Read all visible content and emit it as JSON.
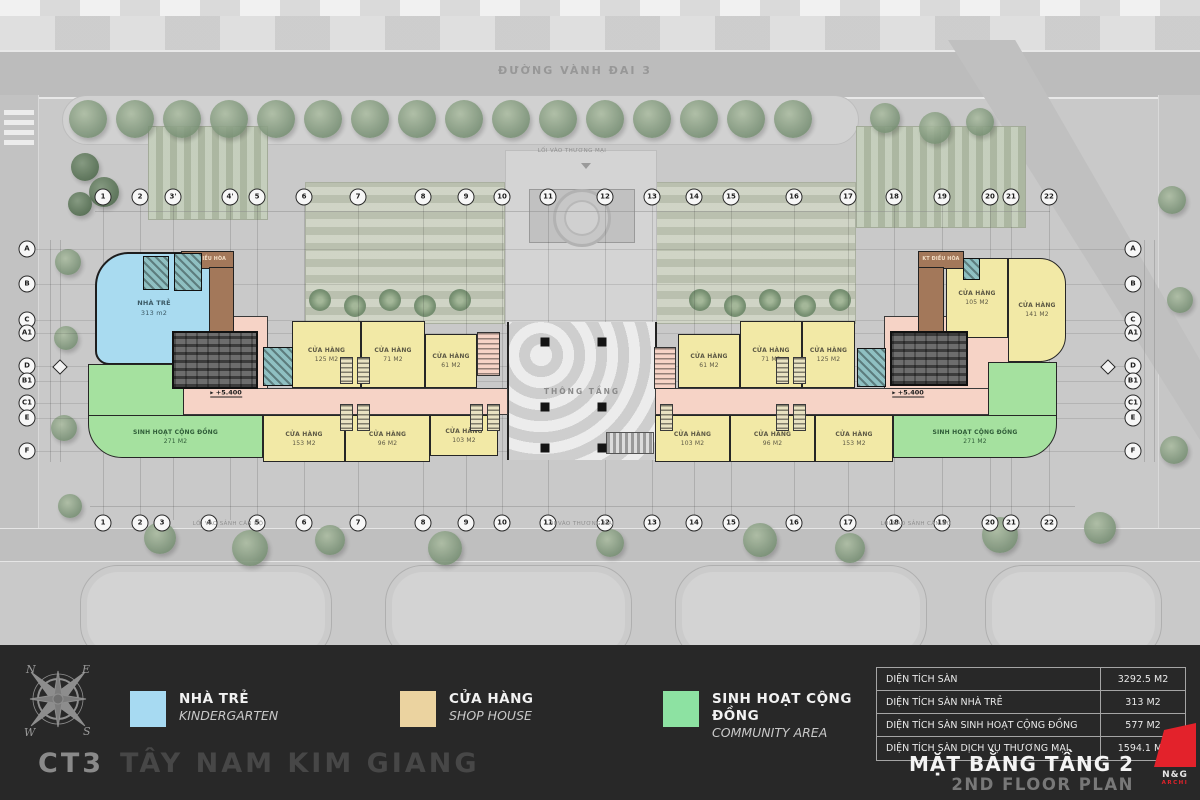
{
  "site": {
    "road_label": "ĐƯỜNG VÀNH ĐAI 3",
    "entrances": [
      {
        "label": "LỐI VÀO THƯƠNG MẠI",
        "x": 572,
        "y": 151,
        "arrow_y": 166,
        "arrow_x": 586
      },
      {
        "label": "LỐI VÀO SẢNH CĂN HỘ",
        "x": 228,
        "y": 524
      },
      {
        "label": "LỐI VÀO THƯƠNG MẠI",
        "x": 580,
        "y": 524
      },
      {
        "label": "LỐI VÀO SẢNH CĂN HỘ",
        "x": 916,
        "y": 524
      }
    ]
  },
  "plan": {
    "void_label": "THÔNG TẦNG",
    "level_label": "+5.400",
    "level_markers": [
      {
        "x": 226,
        "y": 393
      },
      {
        "x": 908,
        "y": 393
      }
    ],
    "grid_top": [
      {
        "label": "1",
        "x": 103
      },
      {
        "label": "2",
        "x": 140
      },
      {
        "label": "3'",
        "x": 173
      },
      {
        "label": "4'",
        "x": 230
      },
      {
        "label": "5",
        "x": 257
      },
      {
        "label": "6",
        "x": 304
      },
      {
        "label": "7",
        "x": 358
      },
      {
        "label": "8",
        "x": 423
      },
      {
        "label": "9",
        "x": 466
      },
      {
        "label": "10",
        "x": 502
      },
      {
        "label": "11",
        "x": 548
      },
      {
        "label": "12",
        "x": 605
      },
      {
        "label": "13",
        "x": 652
      },
      {
        "label": "14",
        "x": 694
      },
      {
        "label": "15",
        "x": 731
      },
      {
        "label": "16",
        "x": 794
      },
      {
        "label": "17",
        "x": 848
      },
      {
        "label": "18",
        "x": 894
      },
      {
        "label": "19",
        "x": 942
      },
      {
        "label": "20",
        "x": 990
      },
      {
        "label": "21",
        "x": 1011
      },
      {
        "label": "22",
        "x": 1049
      }
    ],
    "grid_bottom": [
      {
        "label": "1",
        "x": 103
      },
      {
        "label": "2",
        "x": 140
      },
      {
        "label": "3",
        "x": 162
      },
      {
        "label": "4",
        "x": 209
      },
      {
        "label": "5",
        "x": 257
      },
      {
        "label": "6",
        "x": 304
      },
      {
        "label": "7",
        "x": 358
      },
      {
        "label": "8",
        "x": 423
      },
      {
        "label": "9",
        "x": 466
      },
      {
        "label": "10",
        "x": 502
      },
      {
        "label": "11",
        "x": 548
      },
      {
        "label": "12",
        "x": 605
      },
      {
        "label": "13",
        "x": 652
      },
      {
        "label": "14",
        "x": 694
      },
      {
        "label": "15",
        "x": 731
      },
      {
        "label": "16",
        "x": 794
      },
      {
        "label": "17",
        "x": 848
      },
      {
        "label": "18",
        "x": 894
      },
      {
        "label": "19",
        "x": 942
      },
      {
        "label": "20",
        "x": 990
      },
      {
        "label": "21",
        "x": 1011
      },
      {
        "label": "22",
        "x": 1049
      }
    ],
    "grid_left": [
      {
        "label": "A",
        "y": 249
      },
      {
        "label": "B",
        "y": 284
      },
      {
        "label": "C",
        "y": 320
      },
      {
        "label": "A1",
        "y": 333
      },
      {
        "label": "D",
        "y": 366
      },
      {
        "label": "B1",
        "y": 381
      },
      {
        "label": "C1",
        "y": 403
      },
      {
        "label": "E",
        "y": 418
      },
      {
        "label": "F",
        "y": 451
      }
    ],
    "grid_right": [
      {
        "label": "A",
        "y": 249
      },
      {
        "label": "B",
        "y": 284
      },
      {
        "label": "C",
        "y": 320
      },
      {
        "label": "A1",
        "y": 333
      },
      {
        "label": "D",
        "y": 366
      },
      {
        "label": "B1",
        "y": 381
      },
      {
        "label": "C1",
        "y": 403
      },
      {
        "label": "E",
        "y": 418
      },
      {
        "label": "F",
        "y": 451
      }
    ],
    "rooms": [
      {
        "t": "corridor",
        "x": 150,
        "y": 316,
        "w": 118,
        "h": 75
      },
      {
        "t": "corridor",
        "x": 150,
        "y": 388,
        "w": 358,
        "h": 27
      },
      {
        "t": "corridor",
        "x": 884,
        "y": 316,
        "w": 158,
        "h": 75
      },
      {
        "t": "corridor",
        "x": 655,
        "y": 388,
        "w": 387,
        "h": 27
      },
      {
        "t": "kindergarten",
        "x": 95,
        "y": 252,
        "w": 118,
        "h": 113,
        "r": "34px 0 0 14px",
        "n": "NHÀ TRẺ",
        "a": "313 m2"
      },
      {
        "t": "community",
        "x": 88,
        "y": 364,
        "w": 96,
        "h": 52
      },
      {
        "t": "community",
        "x": 88,
        "y": 415,
        "w": 175,
        "h": 43,
        "r": "0 0 0 34px",
        "n": "SINH HOẠT CỘNG ĐỒNG",
        "a": "271 M2"
      },
      {
        "t": "community",
        "x": 988,
        "y": 362,
        "w": 69,
        "h": 54
      },
      {
        "t": "community",
        "x": 893,
        "y": 415,
        "w": 164,
        "h": 43,
        "r": "0 0 34px 0",
        "n": "SINH HOẠT CỘNG ĐỒNG",
        "a": "271 M2"
      },
      {
        "t": "shop",
        "x": 292,
        "y": 321,
        "w": 69,
        "h": 67,
        "n": "CỬA HÀNG",
        "a": "125 M2"
      },
      {
        "t": "shop",
        "x": 361,
        "y": 321,
        "w": 64,
        "h": 67,
        "n": "CỬA HÀNG",
        "a": "71 M2"
      },
      {
        "t": "shop",
        "x": 425,
        "y": 334,
        "w": 52,
        "h": 54,
        "n": "CỬA HÀNG",
        "a": "61 M2"
      },
      {
        "t": "shop",
        "x": 263,
        "y": 415,
        "w": 82,
        "h": 47,
        "n": "CỬA HÀNG",
        "a": "153 M2"
      },
      {
        "t": "shop",
        "x": 345,
        "y": 415,
        "w": 85,
        "h": 47,
        "n": "CỬA HÀNG",
        "a": "96 M2"
      },
      {
        "t": "shop",
        "x": 430,
        "y": 415,
        "w": 68,
        "h": 41,
        "n": "CỬA HÀNG",
        "a": "103 M2"
      },
      {
        "t": "shop",
        "x": 678,
        "y": 334,
        "w": 62,
        "h": 54,
        "n": "CỬA HÀNG",
        "a": "61 M2"
      },
      {
        "t": "shop",
        "x": 740,
        "y": 321,
        "w": 62,
        "h": 67,
        "n": "CỬA HÀNG",
        "a": "71 M2"
      },
      {
        "t": "shop",
        "x": 802,
        "y": 321,
        "w": 53,
        "h": 67,
        "n": "CỬA HÀNG",
        "a": "125 M2"
      },
      {
        "t": "shop",
        "x": 655,
        "y": 415,
        "w": 75,
        "h": 47,
        "n": "CỬA HÀNG",
        "a": "103 M2"
      },
      {
        "t": "shop",
        "x": 730,
        "y": 415,
        "w": 85,
        "h": 47,
        "n": "CỬA HÀNG",
        "a": "96 M2"
      },
      {
        "t": "shop",
        "x": 815,
        "y": 415,
        "w": 78,
        "h": 47,
        "n": "CỬA HÀNG",
        "a": "153 M2"
      },
      {
        "t": "shop",
        "x": 946,
        "y": 258,
        "w": 62,
        "h": 80,
        "n": "CỬA HÀNG",
        "a": "105 M2"
      },
      {
        "t": "shop",
        "x": 1008,
        "y": 258,
        "w": 58,
        "h": 104,
        "r": "0 26px 26px 0",
        "n": "CỬA HÀNG",
        "a": "141 M2"
      },
      {
        "t": "kt",
        "x": 181,
        "y": 251,
        "w": 53,
        "h": 18,
        "n": "KT ĐIỀU HÒA"
      },
      {
        "t": "kt",
        "x": 209,
        "y": 267,
        "w": 25,
        "h": 68
      },
      {
        "t": "kt",
        "x": 918,
        "y": 251,
        "w": 46,
        "h": 18,
        "n": "KT ĐIỀU HÒA"
      },
      {
        "t": "kt",
        "x": 918,
        "y": 267,
        "w": 26,
        "h": 68
      },
      {
        "t": "tech",
        "x": 143,
        "y": 256,
        "w": 26,
        "h": 34
      },
      {
        "t": "tech",
        "x": 174,
        "y": 253,
        "w": 28,
        "h": 38
      },
      {
        "t": "core",
        "x": 172,
        "y": 331,
        "w": 86,
        "h": 58
      },
      {
        "t": "tech",
        "x": 263,
        "y": 347,
        "w": 30,
        "h": 39
      },
      {
        "t": "core",
        "x": 890,
        "y": 331,
        "w": 78,
        "h": 55
      },
      {
        "t": "tech",
        "x": 857,
        "y": 348,
        "w": 29,
        "h": 39
      },
      {
        "t": "tech",
        "x": 963,
        "y": 258,
        "w": 17,
        "h": 22
      },
      {
        "t": "stair",
        "x": 477,
        "y": 332,
        "w": 23,
        "h": 44
      },
      {
        "t": "stair",
        "x": 654,
        "y": 347,
        "w": 22,
        "h": 42
      },
      {
        "t": "stairg",
        "x": 340,
        "y": 357,
        "w": 13,
        "h": 27
      },
      {
        "t": "stairg",
        "x": 357,
        "y": 357,
        "w": 13,
        "h": 27
      },
      {
        "t": "stairg",
        "x": 340,
        "y": 404,
        "w": 13,
        "h": 27
      },
      {
        "t": "stairg",
        "x": 357,
        "y": 404,
        "w": 13,
        "h": 27
      },
      {
        "t": "stairg",
        "x": 470,
        "y": 404,
        "w": 13,
        "h": 27
      },
      {
        "t": "stairg",
        "x": 487,
        "y": 404,
        "w": 13,
        "h": 27
      },
      {
        "t": "stairg",
        "x": 776,
        "y": 357,
        "w": 13,
        "h": 27
      },
      {
        "t": "stairg",
        "x": 793,
        "y": 357,
        "w": 13,
        "h": 27
      },
      {
        "t": "stairg",
        "x": 776,
        "y": 404,
        "w": 13,
        "h": 27
      },
      {
        "t": "stairg",
        "x": 793,
        "y": 404,
        "w": 13,
        "h": 27
      },
      {
        "t": "stairg",
        "x": 660,
        "y": 404,
        "w": 13,
        "h": 27
      }
    ]
  },
  "legend": {
    "items": [
      {
        "label": "NHÀ TRẺ",
        "sublabel": "KINDERGARTEN",
        "color": "#a7daf2",
        "x": 130
      },
      {
        "label": "CỬA HÀNG",
        "sublabel": "SHOP HOUSE",
        "color": "#ebd3a0",
        "x": 400
      },
      {
        "label": "SINH HOẠT CỘNG ĐỒNG",
        "sublabel": "COMMUNITY AREA",
        "color": "#8de2a2",
        "x": 663
      }
    ]
  },
  "stats": {
    "rows": [
      {
        "label": "DIỆN TÍCH SÀN",
        "value": "3292.5 M2"
      },
      {
        "label": "DIỆN TÍCH SÀN NHÀ TRẺ",
        "value": "313 M2"
      },
      {
        "label": "DIỆN TÍCH SÀN SINH HOẠT CỘNG ĐỒNG",
        "value": "577 M2"
      },
      {
        "label": "DIỆN TÍCH SÀN DỊCH VỤ THƯƠNG MẠI",
        "value": "1594.1 M2"
      }
    ]
  },
  "footer": {
    "project_code": "CT3",
    "project_name": "TÂY NAM KIM GIANG",
    "plan_title": "MẶT BẰNG TẦNG 2",
    "plan_subtitle": "2ND FLOOR PLAN",
    "logo_text": "N&G",
    "logo_subtext": "ARCHI"
  },
  "compass": {
    "n": "N",
    "e": "E",
    "s": "S",
    "w": "W"
  }
}
